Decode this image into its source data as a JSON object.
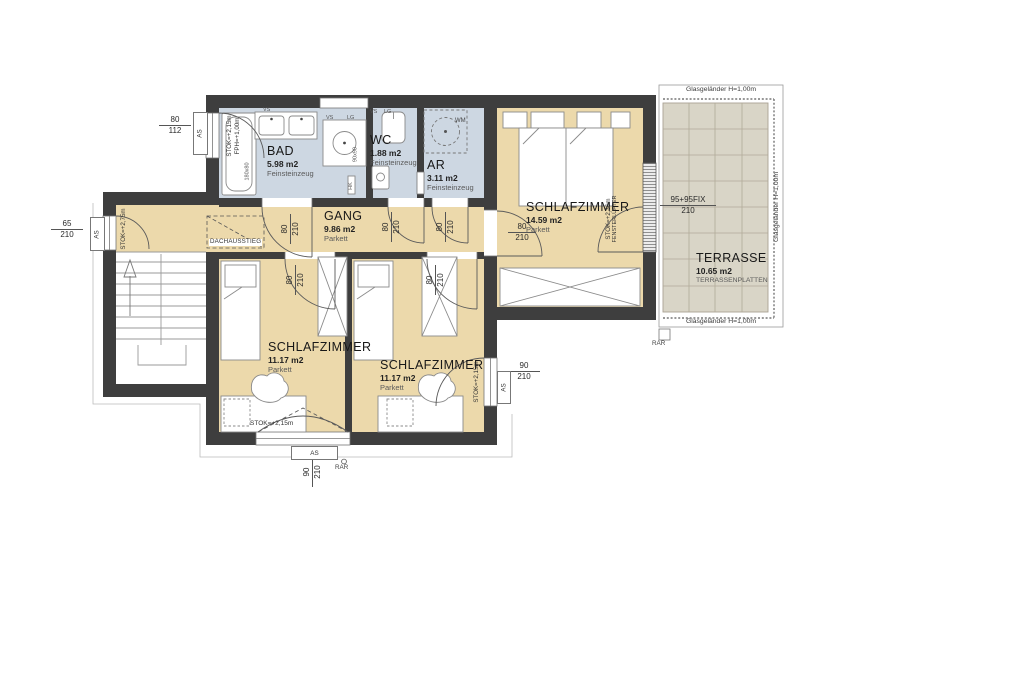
{
  "title": "Dachgeschoss Grundriss",
  "colors": {
    "wall": "#3e3e3e",
    "parkett_floor": "#ecd9ab",
    "tile_floor": "#cdd7e2",
    "terrace_floor": "#d9d5c7",
    "terrace_grid": "#b0a998",
    "line": "#555555"
  },
  "rooms": {
    "bad": {
      "name": "BAD",
      "area": "5.98 m2",
      "floor": "Feinsteinzeug"
    },
    "wc": {
      "name": "WC",
      "area": "1.88 m2",
      "floor": "Feinsteinzeug"
    },
    "ar": {
      "name": "AR",
      "area": "3.11 m2",
      "floor": "Feinsteinzeug"
    },
    "gang": {
      "name": "GANG",
      "area": "9.86 m2",
      "floor": "Parkett"
    },
    "schlafzimmer_top": {
      "name": "SCHLAFZIMMER",
      "area": "14.59 m2",
      "floor": "Parkett"
    },
    "schlafzimmer_left": {
      "name": "SCHLAFZIMMER",
      "area": "11.17 m2",
      "floor": "Parkett"
    },
    "schlafzimmer_mid": {
      "name": "SCHLAFZIMMER",
      "area": "11.17 m2",
      "floor": "Parkett"
    },
    "terrasse": {
      "name": "TERRASSE",
      "area": "10.65 m2",
      "floor": "TERRASSENPLATTEN"
    }
  },
  "railing": {
    "label": "Glasgeländer H=1,00m"
  },
  "dims": {
    "door": {
      "w": "80",
      "h": "210"
    },
    "bad_window": {
      "w": "80",
      "h": "112"
    },
    "gang_window": {
      "w": "65",
      "h": "210"
    },
    "right_window": {
      "w": "90",
      "h": "210"
    },
    "bottom_window": {
      "w": "90",
      "h": "210"
    },
    "fix_window": {
      "w": "95+95FIX",
      "h": "210"
    }
  },
  "levels": {
    "gang_stok": "STOK=+2,75m",
    "bad_stok": "STOK=+2,15m",
    "bad_fph": "FPH=+1,00m",
    "terrace_stok": "STOK=+2,36m",
    "terrace_vent": "FENSTERLÜFTER",
    "stok_215": "STOK=+2,15m"
  },
  "marks": {
    "as": "AS",
    "rar": "RAR",
    "wm": "WM",
    "hk": "HK",
    "vs": "VS",
    "lg": "LG",
    "tub": "180x80",
    "shower": "90x90",
    "dachausstieg": "DACHAUSSTIEG"
  }
}
